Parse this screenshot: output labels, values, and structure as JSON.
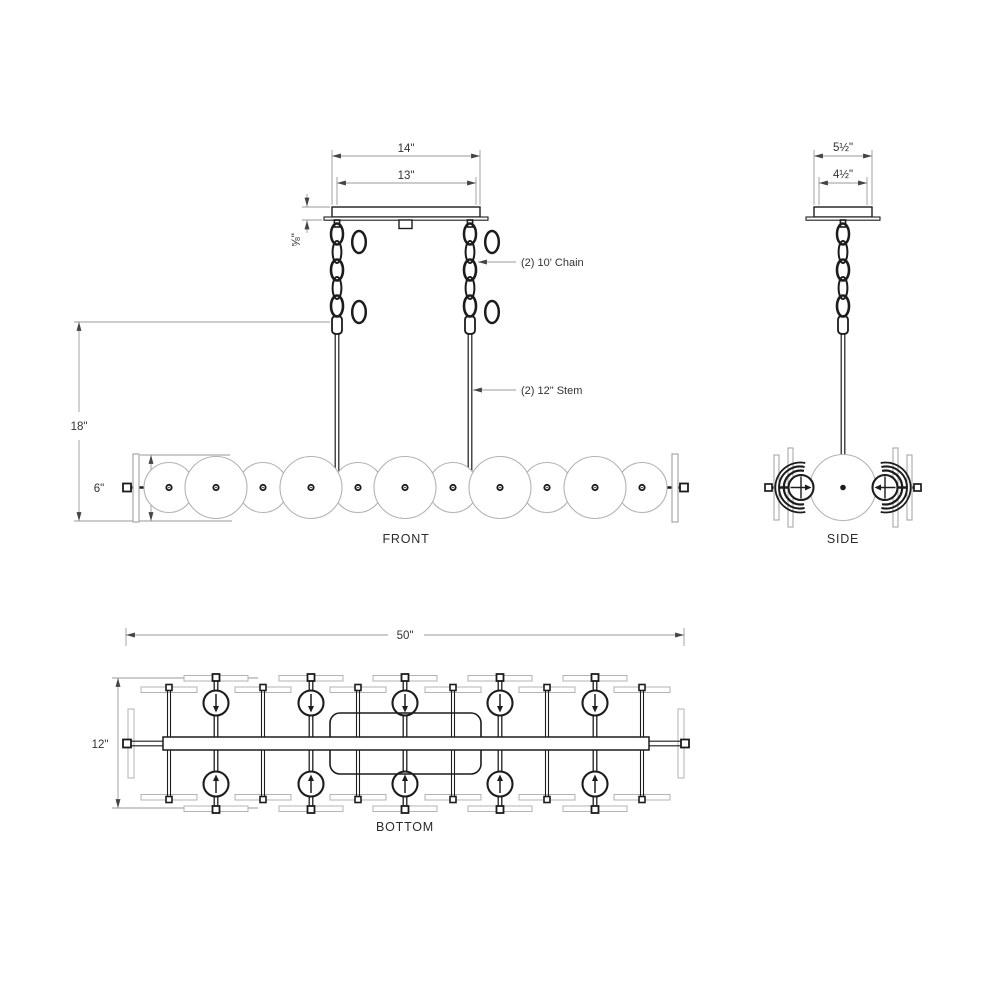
{
  "drawing": {
    "title": "chandelier-dimension-drawing",
    "views": {
      "front": {
        "label": "FRONT",
        "dim_canopy_outer": "14\"",
        "dim_canopy_inner": "13\"",
        "dim_canopy_height": "⅝\"",
        "dim_overall_drop": "18\"",
        "dim_body_height": "6\"",
        "callout_chain": "(2)   10' Chain",
        "callout_stem": "(2)   12\" Stem"
      },
      "side": {
        "label": "SIDE",
        "dim_canopy_outer": "5½\"",
        "dim_canopy_inner": "4½\""
      },
      "bottom": {
        "label": "BOTTOM",
        "dim_length": "50\"",
        "dim_width": "12\""
      }
    },
    "colors": {
      "line_dark": "#1c1c1c",
      "line_light": "#b3b3b3",
      "dim_line": "#9a9a9a",
      "text": "#333333",
      "background": "#ffffff"
    }
  }
}
